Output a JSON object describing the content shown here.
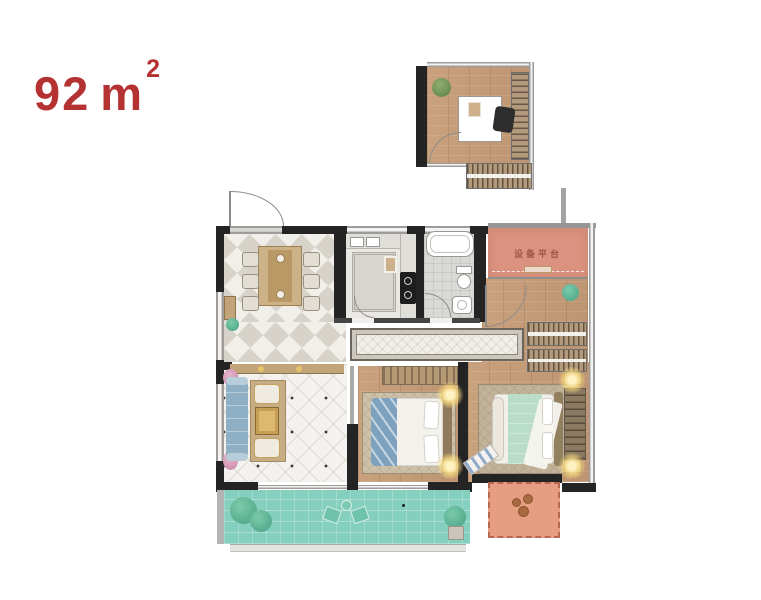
{
  "header": {
    "area_value": "92",
    "area_unit": "m",
    "area_exponent": "2"
  },
  "floor_plan": {
    "equipment_platform_label": "设备平台",
    "palette": {
      "area_label_red": "#b43231",
      "wall_dark": "#242424",
      "window_wall_gray": "#9e9c9a",
      "wood_floor_tan": "#c59d79",
      "dining_tile_gray": "#d7d2ca",
      "equipment_platform_orange": "#d5806a",
      "main_balcony_teal": "#84cfbe",
      "small_balcony_salmon": "#e69e82",
      "sofa_blue": "#8fb0c4",
      "bed_throw_blue": "#7ea2bd",
      "bed_duvet_mint": "#b9ddc8"
    }
  }
}
